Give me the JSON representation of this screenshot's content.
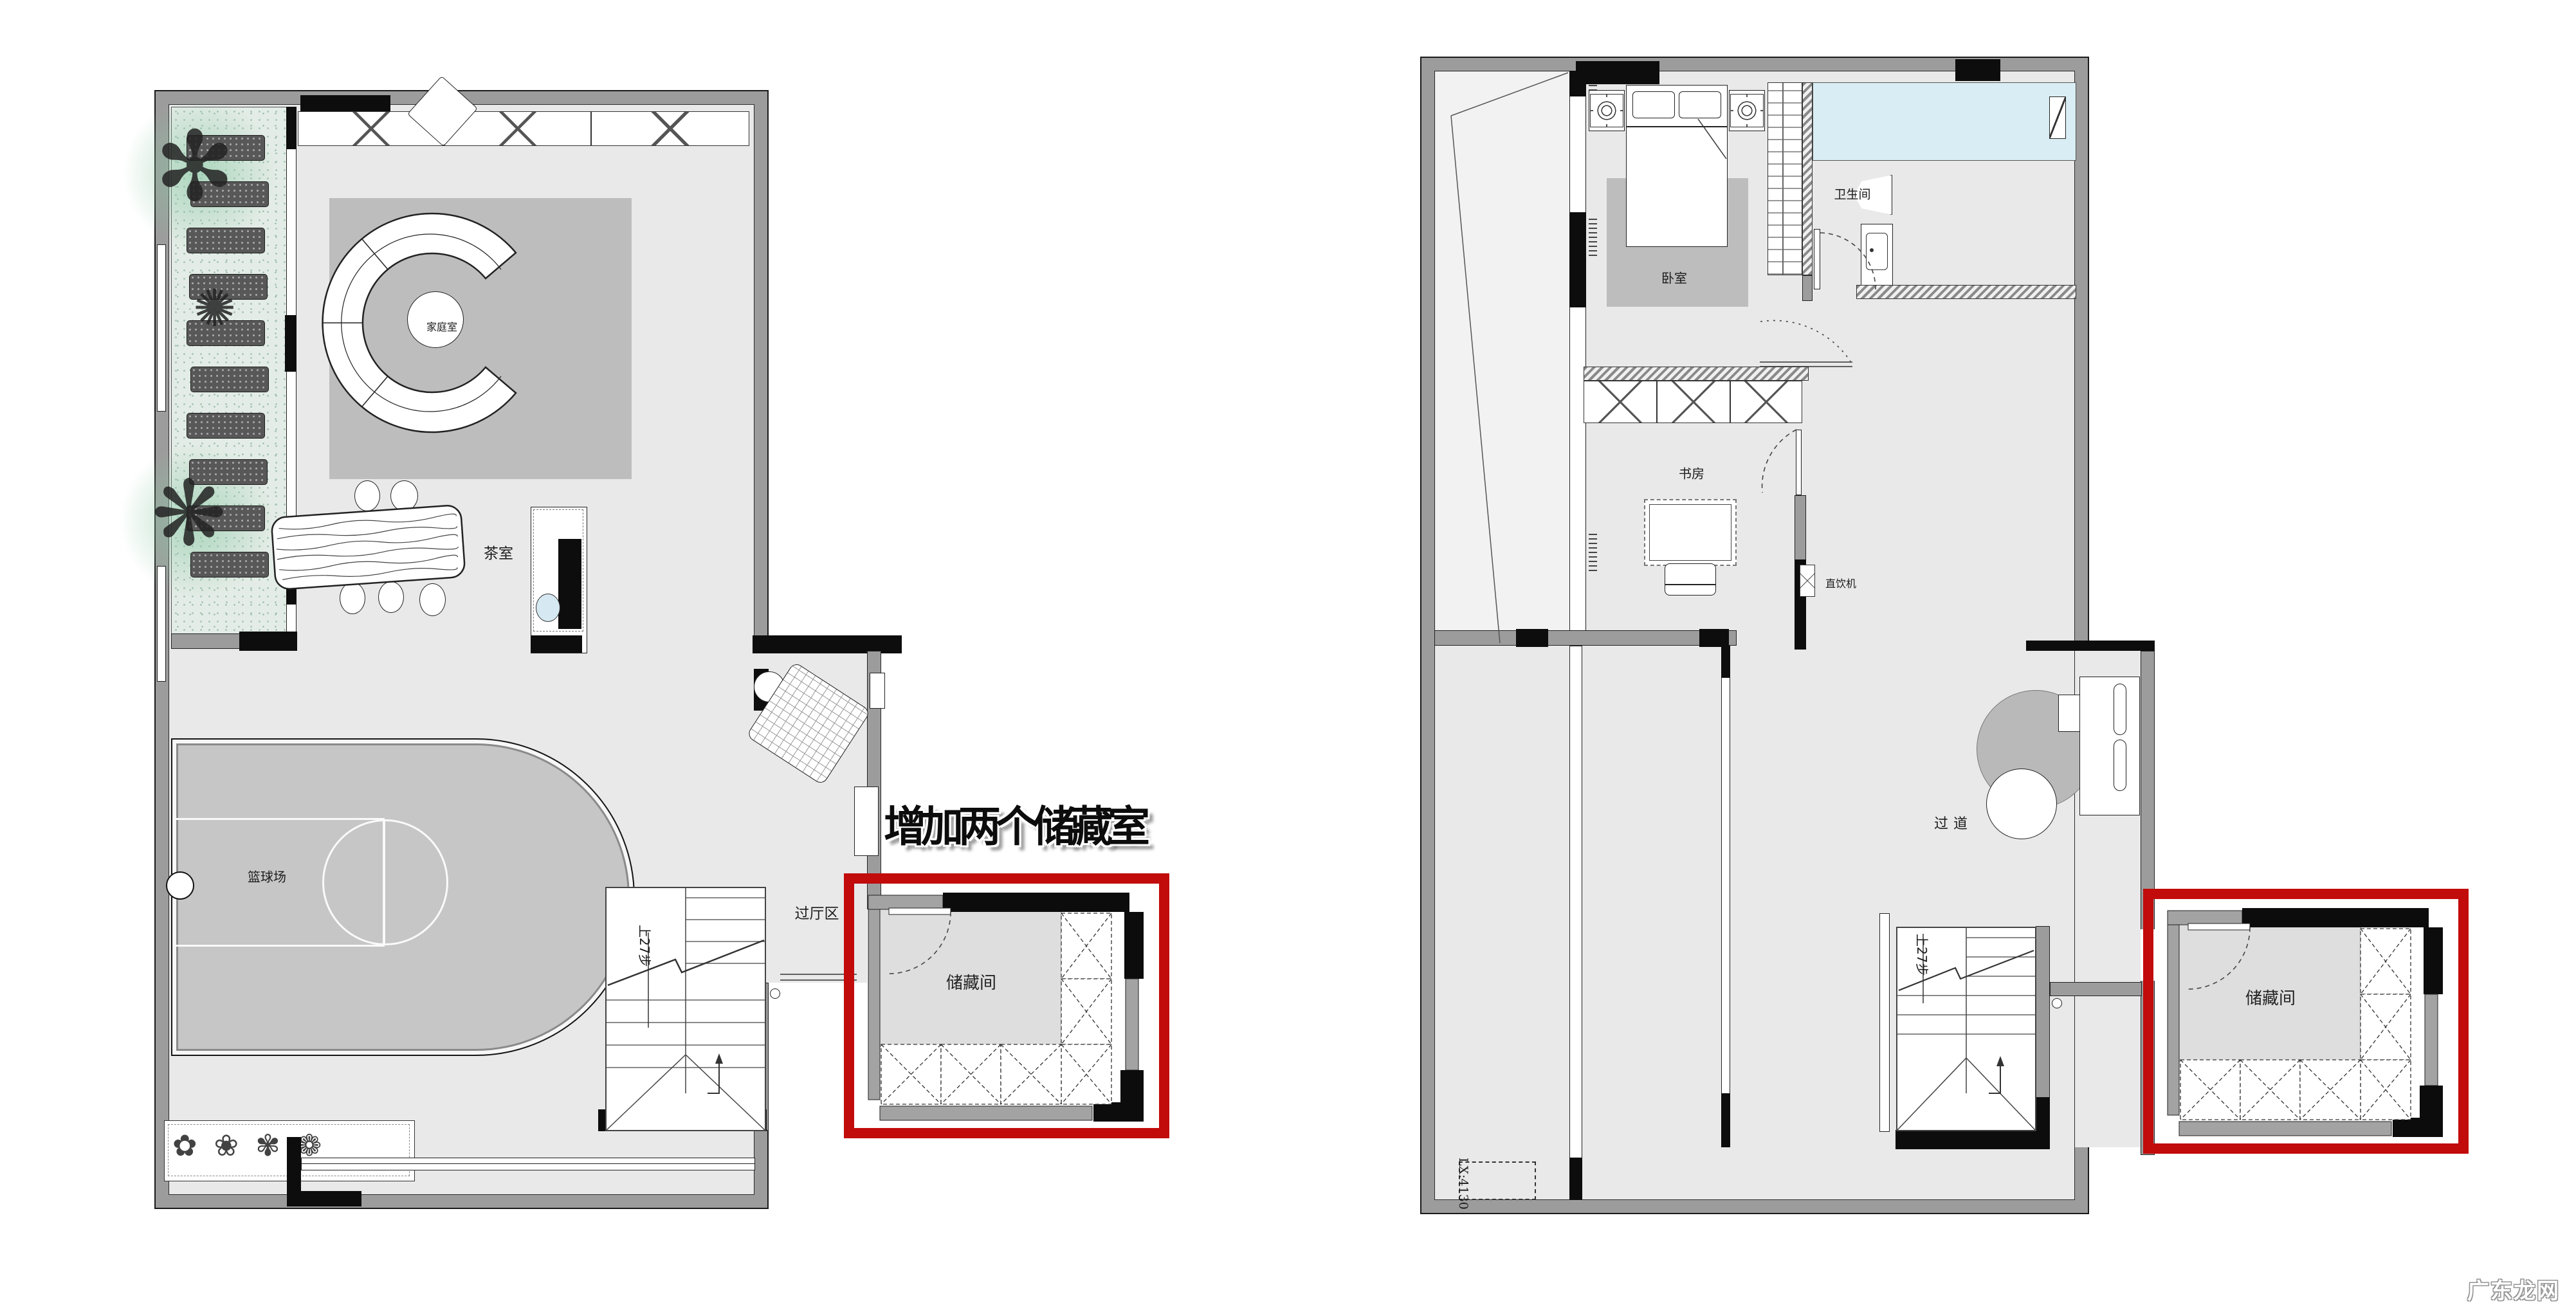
{
  "annotation": {
    "text": "增加两个储藏室"
  },
  "watermark": {
    "text": "广东龙网"
  },
  "colors": {
    "highlight_red": "#c20b0b",
    "wall_gray": "#9c9c9c",
    "wall_black": "#0d0d0d",
    "floor_gray": "#e9e9e9",
    "court_gray": "#c6c6c6",
    "rug_gray": "#bdbdbd",
    "garden_green": "#e3ece6",
    "shower_blue": "#d9edf4"
  },
  "left_plan": {
    "labels": {
      "family_room": "家庭室",
      "tea_room": "茶室",
      "basketball_court": "篮球场",
      "hall_area": "过厅区",
      "stairs": "上27步",
      "storage": "储藏间"
    }
  },
  "right_plan": {
    "labels": {
      "bedroom": "卧室",
      "bathroom": "卫生间",
      "study": "书房",
      "water_dispenser": "直饮机",
      "corridor": "过道",
      "stairs": "上27步",
      "storage": "储藏间",
      "dimension_note": "LX:4130"
    }
  }
}
